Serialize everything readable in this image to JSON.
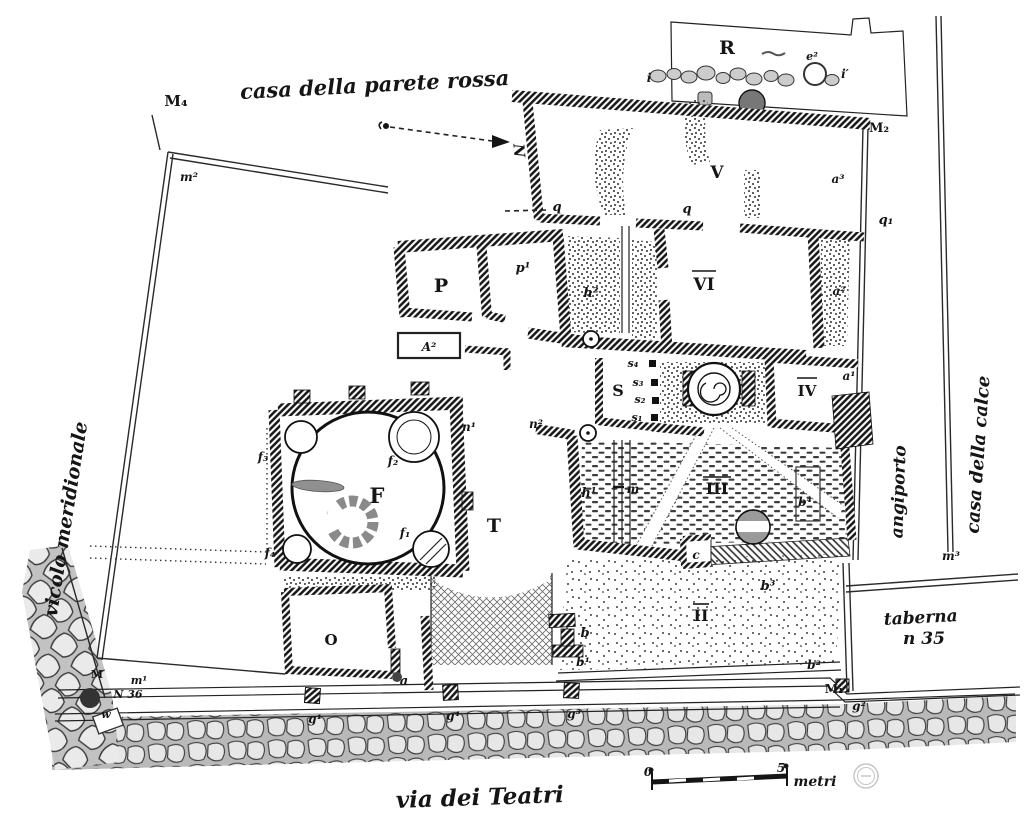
{
  "colors": {
    "ink": "#1a1a1a",
    "paper": "#ffffff",
    "stone": "#e7e7e7",
    "street_bg": "#b9b9b9"
  },
  "title": {
    "top": "casa della parete rossa"
  },
  "streets": {
    "bottom": "via dei Teatri",
    "left": "vicolo meridionale",
    "alley_right": "angiporto",
    "house_right": "casa della calce",
    "taberna_line1": "taberna",
    "taberna_line2": "n 35"
  },
  "compass": {
    "north": "N"
  },
  "scale": {
    "zero": "0",
    "five": "5",
    "unit": "metri"
  },
  "rooms": {
    "R": "R",
    "V": "V",
    "VI": "VI",
    "IV": "IV",
    "III": "III",
    "II": "II",
    "P": "P",
    "S": "S",
    "F": "F",
    "T": "T",
    "O": "O"
  },
  "markers": {
    "M4": "M₄",
    "M2": "M₂",
    "M1": "M₁",
    "M": "M",
    "m1": "m¹",
    "m2": "m²",
    "m3": "m³",
    "N36": "N 36",
    "w": "w"
  },
  "letters": {
    "p1": "p¹",
    "h1": "h¹",
    "h2": "h²",
    "A2": "A²",
    "a": "a",
    "a1": "a¹",
    "a2": "a²",
    "a3": "a³",
    "b": "b",
    "b1": "b¹",
    "b2": "b²",
    "b3": "b³",
    "b4": "b⁴",
    "c": "c",
    "e2": "e²",
    "i": "i",
    "i1": "i′",
    "m": "m",
    "n1": "n¹",
    "n2": "n²",
    "s1": "s₁",
    "s2": "s₂",
    "s3": "s₃",
    "s4": "s₄",
    "f1": "f₁",
    "f2": "f₂",
    "f3": "f₃",
    "f4": "f₄",
    "q_a": "q",
    "q_b": "q",
    "q1": "q₁",
    "g1": "g¹",
    "g2": "g²",
    "g3": "g³",
    "g4": "g⁴"
  }
}
